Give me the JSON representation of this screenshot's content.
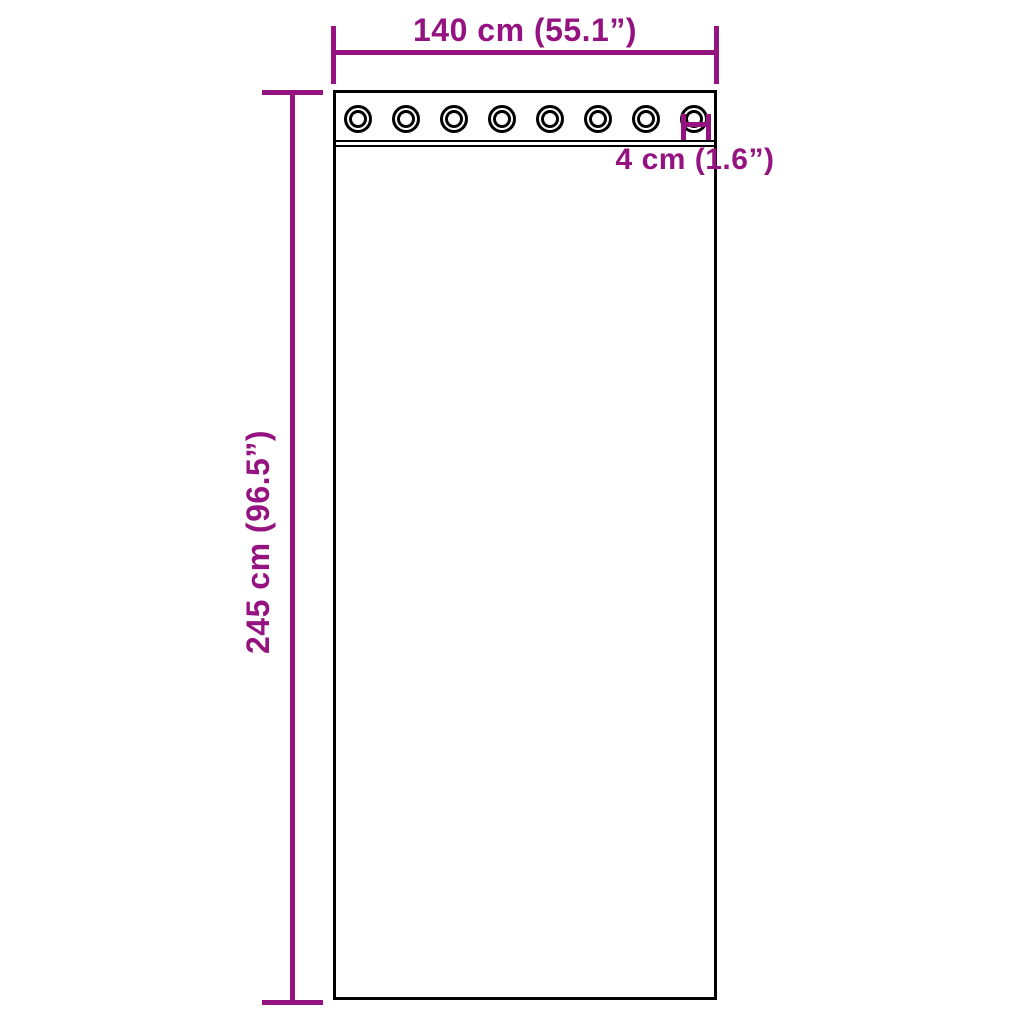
{
  "diagram": {
    "width_label": "140 cm (55.1”)",
    "height_label": "245 cm (96.5”)",
    "grommet_dim_label": "4 cm (1.6”)",
    "grommet_count": 8
  },
  "colors": {
    "dimension": "#941380",
    "outline": "#000000",
    "background": "#ffffff"
  }
}
